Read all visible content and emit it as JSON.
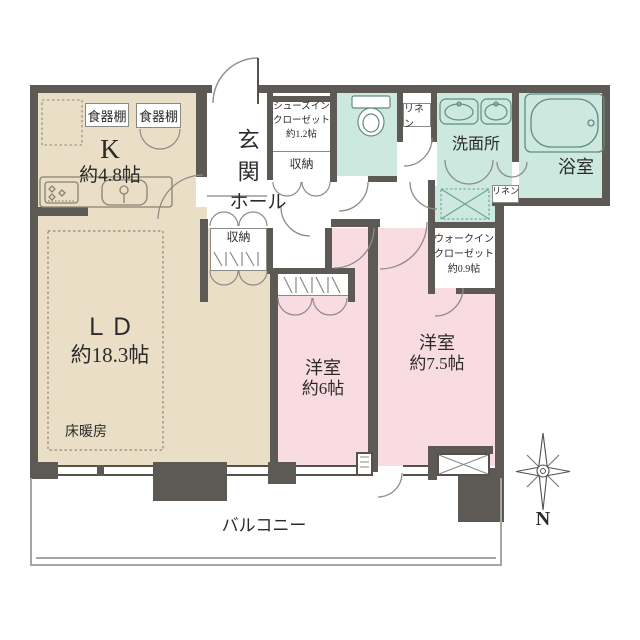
{
  "colors": {
    "wall": "#5d5a55",
    "room_beige": "#eadec6",
    "room_pink": "#f9dbe2",
    "room_teal": "#cde9df",
    "line": "#8a8a85"
  },
  "rooms": {
    "kitchen": {
      "label": "K",
      "size": "約4.8帖"
    },
    "cupboard_left": {
      "label": "食器棚"
    },
    "cupboard_right": {
      "label": "食器棚"
    },
    "living_dining": {
      "label": "ＬＤ",
      "size": "約18.3帖",
      "floor_heating": "床暖房"
    },
    "entrance": {
      "label": "玄関"
    },
    "hall": {
      "label": "ホール"
    },
    "shoes_in_closet": {
      "line1": "シューズイン",
      "line2": "クローゼット",
      "line3": "約1.2帖"
    },
    "storage_under_sic": {
      "label": "収納"
    },
    "storage_hall": {
      "label": "収納"
    },
    "linen_top": {
      "label": "リネン"
    },
    "linen_side": {
      "label": "リネン"
    },
    "washroom": {
      "label": "洗面所"
    },
    "bathroom": {
      "label": "浴室"
    },
    "walk_in_closet": {
      "line1": "ウォークイン",
      "line2": "クローゼット",
      "line3": "約0.9帖"
    },
    "bedroom_6": {
      "label": "洋室",
      "size": "約6帖"
    },
    "bedroom_7_5": {
      "label": "洋室",
      "size": "約7.5帖"
    },
    "balcony": {
      "label": "バルコニー"
    }
  },
  "compass": {
    "north_label": "N"
  }
}
